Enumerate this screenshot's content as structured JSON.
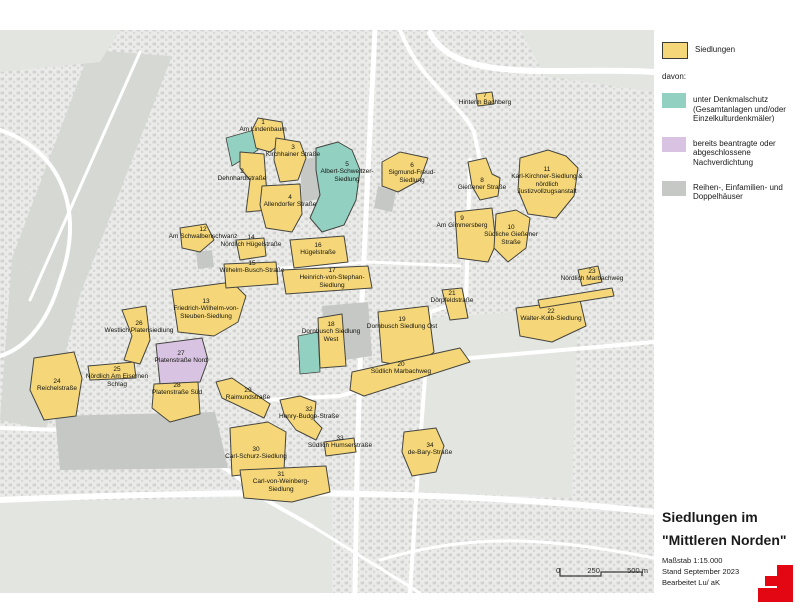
{
  "legend": {
    "items": [
      {
        "key": "standard",
        "label": "Siedlungen"
      },
      {
        "key": "denkmal",
        "label": "unter Denkmalschutz (Gesamtanlagen und/oder Einzelkulturdenkmäler)"
      },
      {
        "key": "nachverdichtung",
        "label": "bereits beantragte oder abgeschlossene Nachverdichtung"
      },
      {
        "key": "gray",
        "label": "Reihen-, Einfamilien- und Doppelhäuser"
      }
    ],
    "davon": "davon:"
  },
  "title_block": {
    "line1": "Siedlungen im",
    "line2": "\"Mittleren Norden\"",
    "meta1": "Maßstab 1:15.000",
    "meta2": "Stand September 2023",
    "meta3": "Bearbeitet  Lu/ aK"
  },
  "scalebar": {
    "ticks": [
      "0",
      "250",
      "500 m"
    ]
  },
  "map": {
    "colors": {
      "standard": "#f5d77a",
      "denkmal": "#92d0c2",
      "nachverdichtung": "#d8c3e2",
      "gray": "#c6c8c5",
      "outline": "#45453f",
      "background": "#ebecea",
      "park": "#d6d8d4",
      "park_light": "#e3e5e1",
      "road": "#ffffff"
    },
    "parks": [
      {
        "shade": "park",
        "points": "90,50 172,56 80,295 12,258"
      },
      {
        "shade": "park",
        "points": "12,258 80,295 46,430 0,420"
      },
      {
        "shade": "park_light",
        "points": "0,30 120,30 100,62 0,72"
      },
      {
        "shade": "park_light",
        "points": "520,30 654,30 654,92 545,76"
      },
      {
        "shade": "park_light",
        "points": "0,502 332,496 332,593 0,593"
      },
      {
        "shade": "park_light",
        "points": "425,318 578,308 572,498 418,492"
      }
    ],
    "gray_areas": [
      {
        "points": "322,306 368,302 372,356 344,360 342,330 324,332"
      },
      {
        "points": "55,416 215,412 228,468 60,470"
      },
      {
        "points": "300,160 322,156 326,198 302,202"
      },
      {
        "points": "378,186 396,192 392,212 374,208"
      },
      {
        "points": "462,212 478,210 480,225 464,227"
      },
      {
        "points": "196,252 212,250 214,267 198,269"
      }
    ],
    "roads": [
      {
        "d": "M375,30 L369,150 L362,300 L357,470 L355,593",
        "w": 5
      },
      {
        "d": "M430,33 C458,86 560,66 654,72",
        "w": 6
      },
      {
        "d": "M400,30 C420,82 458,100 474,132 L480,160",
        "w": 4
      },
      {
        "d": "M470,160 L466,300 L430,312 L418,470 L410,593",
        "w": 4
      },
      {
        "d": "M0,130 C60,150 86,210 60,280 C46,330 20,350 0,356",
        "w": 4
      },
      {
        "d": "M140,52 L30,300",
        "w": 3
      },
      {
        "d": "M228,272 L370,262 L460,266",
        "w": 3
      },
      {
        "d": "M232,402 L340,396 L470,358 L654,342",
        "w": 4
      },
      {
        "d": "M0,428 L130,432 C190,438 226,468 266,500 L312,526",
        "w": 4
      },
      {
        "d": "M0,500 C180,492 420,486 654,512",
        "w": 6
      },
      {
        "d": "M312,526 L420,593",
        "w": 3
      },
      {
        "d": "M380,560 C480,530 560,540 654,558",
        "w": 3
      }
    ],
    "extra_patches": [
      {
        "type": "denkmal",
        "points": "226,138 254,130 258,150 232,166"
      },
      {
        "type": "denkmal",
        "points": "298,336 318,332 320,372 300,374"
      }
    ],
    "settlements": [
      {
        "id": "1",
        "name": "Am Lindenbaum",
        "type": "standard",
        "polys": [
          "258,118 282,122 285,140 270,152 256,148 252,130"
        ],
        "label": {
          "x": 263,
          "y": 119
        }
      },
      {
        "id": "2",
        "name": "Dehnhardtstraße",
        "type": "standard",
        "polys": [
          "240,152 264,154 268,210 246,212 250,180 240,168"
        ],
        "label": {
          "x": 242,
          "y": 168
        }
      },
      {
        "id": "3",
        "name": "Kirchhainer Straße",
        "type": "standard",
        "polys": [
          "276,138 300,142 306,158 298,180 280,182 274,160"
        ],
        "label": {
          "x": 293,
          "y": 144
        }
      },
      {
        "id": "4",
        "name": "Allendorfer Straße",
        "type": "standard",
        "polys": [
          "262,186 300,184 302,214 292,232 266,228 260,205"
        ],
        "label": {
          "x": 290,
          "y": 194
        }
      },
      {
        "id": "5",
        "name": "Albert-Schweitzer-Siedlung",
        "type": "denkmal",
        "polys": [
          "316,148 338,142 352,150 360,170 356,200 344,225 322,232 310,218 320,195 316,170"
        ],
        "label": {
          "x": 347,
          "y": 161
        }
      },
      {
        "id": "6",
        "name": "Sigmund-Freud-Siedlung",
        "type": "standard",
        "polys": [
          "382,162 400,152 428,158 420,180 398,192 382,186"
        ],
        "label": {
          "x": 412,
          "y": 162
        }
      },
      {
        "id": "7",
        "name": "Hinterm Bachberg",
        "type": "standard",
        "polys": [
          "476,94 492,92 494,104 478,106"
        ],
        "label": {
          "x": 485,
          "y": 92
        }
      },
      {
        "id": "8",
        "name": "Gießener Straße",
        "type": "standard",
        "polys": [
          "468,162 486,158 492,174 500,178 498,196 480,200 472,186"
        ],
        "label": {
          "x": 482,
          "y": 177
        }
      },
      {
        "id": "9",
        "name": "Am Gimmersberg",
        "type": "standard",
        "polys": [
          "455,212 492,208 496,244 488,262 458,258"
        ],
        "label": {
          "x": 462,
          "y": 215
        }
      },
      {
        "id": "10",
        "name": "Südliche Gießener Straße",
        "type": "standard",
        "polys": [
          "496,214 516,210 530,218 526,248 508,262 494,248"
        ],
        "label": {
          "x": 511,
          "y": 224
        }
      },
      {
        "id": "11",
        "name": "Karl-Kirchner-Siedlung & nördlich Justizvollzugsanstalt",
        "type": "standard",
        "polys": [
          "520,158 548,150 566,156 578,168 574,196 556,218 528,214 518,190"
        ],
        "label": {
          "x": 547,
          "y": 166
        }
      },
      {
        "id": "12",
        "name": "Am Schwalbenschwanz",
        "type": "standard",
        "polys": [
          "180,228 206,224 214,240 200,252 182,248"
        ],
        "label": {
          "x": 203,
          "y": 226
        }
      },
      {
        "id": "13",
        "name": "Friedrich-Wilhelm-von-Steuben-Siedlung",
        "type": "standard",
        "polys": [
          "172,290 232,282 246,296 238,322 214,336 178,332"
        ],
        "label": {
          "x": 206,
          "y": 298
        }
      },
      {
        "id": "14",
        "name": "Nördlich Hügelstraße",
        "type": "standard",
        "polys": [
          "236,240 264,238 266,256 240,260"
        ],
        "label": {
          "x": 251,
          "y": 234
        }
      },
      {
        "id": "15",
        "name": "Wilhelm-Busch-Straße",
        "type": "standard",
        "polys": [
          "224,264 276,262 278,284 226,288"
        ],
        "label": {
          "x": 252,
          "y": 260
        }
      },
      {
        "id": "16",
        "name": "Hügelstraße",
        "type": "standard",
        "polys": [
          "290,240 344,236 348,262 294,268"
        ],
        "label": {
          "x": 318,
          "y": 242
        }
      },
      {
        "id": "17",
        "name": "Heinrich-von-Stephan-Siedlung",
        "type": "standard",
        "polys": [
          "282,270 368,266 372,288 286,294"
        ],
        "label": {
          "x": 332,
          "y": 267
        }
      },
      {
        "id": "18",
        "name": "Dornbusch Siedlung West",
        "type": "standard",
        "polys": [
          "318,318 342,314 346,366 320,368"
        ],
        "label": {
          "x": 331,
          "y": 321
        }
      },
      {
        "id": "19",
        "name": "Dornbusch Siedlung Ost",
        "type": "standard",
        "polys": [
          "378,312 428,306 434,352 414,368 382,362"
        ],
        "label": {
          "x": 402,
          "y": 316
        }
      },
      {
        "id": "20",
        "name": "Südlich Marbachweg",
        "type": "standard",
        "polys": [
          "352,372 460,348 470,362 364,396 350,390"
        ],
        "label": {
          "x": 401,
          "y": 361
        }
      },
      {
        "id": "21",
        "name": "Dörpfeldstraße",
        "type": "standard",
        "polys": [
          "442,290 462,288 468,318 450,320"
        ],
        "label": {
          "x": 452,
          "y": 290
        }
      },
      {
        "id": "22",
        "name": "Walter-Kolb-Siedlung",
        "type": "standard",
        "polys": [
          "516,308 580,300 586,326 552,342 520,336",
          "538,300 612,288 614,296 540,308"
        ],
        "label": {
          "x": 551,
          "y": 308
        }
      },
      {
        "id": "23",
        "name": "Nördlich Marbachweg",
        "type": "standard",
        "polys": [
          "578,270 598,266 602,282 582,286"
        ],
        "label": {
          "x": 592,
          "y": 268
        }
      },
      {
        "id": "24",
        "name": "Reichelstraße",
        "type": "standard",
        "polys": [
          "34,358 74,352 82,378 76,416 44,420 30,390"
        ],
        "label": {
          "x": 57,
          "y": 378
        }
      },
      {
        "id": "25",
        "name": "Nördlich Am Eisernen Schlag",
        "type": "standard",
        "polys": [
          "88,366 134,362 136,378 90,380"
        ],
        "label": {
          "x": 117,
          "y": 366
        }
      },
      {
        "id": "26",
        "name": "Westlich Platensiedlung",
        "type": "standard",
        "polys": [
          "122,310 146,306 150,340 140,364 124,360 132,336"
        ],
        "label": {
          "x": 139,
          "y": 320
        }
      },
      {
        "id": "27",
        "name": "Platenstraße Nord",
        "type": "nachverdichtung",
        "polys": [
          "156,344 202,338 208,360 200,382 160,384"
        ],
        "label": {
          "x": 181,
          "y": 350
        }
      },
      {
        "id": "28",
        "name": "Platenstraße Süd",
        "type": "standard",
        "polys": [
          "154,384 198,382 200,414 170,422 152,408"
        ],
        "label": {
          "x": 177,
          "y": 382
        }
      },
      {
        "id": "29",
        "name": "Raimundstraße",
        "type": "standard",
        "polys": [
          "216,382 232,378 270,404 264,418 222,398"
        ],
        "label": {
          "x": 248,
          "y": 387
        }
      },
      {
        "id": "30",
        "name": "Carl-Schurz-Siedlung",
        "type": "standard",
        "polys": [
          "230,428 268,422 286,432 284,470 232,476"
        ],
        "label": {
          "x": 256,
          "y": 446
        }
      },
      {
        "id": "31",
        "name": "Carl-von-Weinberg-Siedlung",
        "type": "standard",
        "polys": [
          "240,470 326,466 330,492 292,502 244,498"
        ],
        "label": {
          "x": 281,
          "y": 471
        }
      },
      {
        "id": "32",
        "name": "Henry-Budge-Straße",
        "type": "standard",
        "polys": [
          "280,400 300,396 316,402 314,420 322,428 316,440 296,430 284,414"
        ],
        "label": {
          "x": 309,
          "y": 406
        }
      },
      {
        "id": "33",
        "name": "Südlich Humserstraße",
        "type": "standard",
        "polys": [
          "324,442 354,438 356,452 326,456"
        ],
        "label": {
          "x": 340,
          "y": 435
        }
      },
      {
        "id": "34",
        "name": "de-Bary-Straße",
        "type": "standard",
        "polys": [
          "404,432 436,428 444,446 436,472 412,476 402,452"
        ],
        "label": {
          "x": 430,
          "y": 442
        }
      }
    ]
  }
}
